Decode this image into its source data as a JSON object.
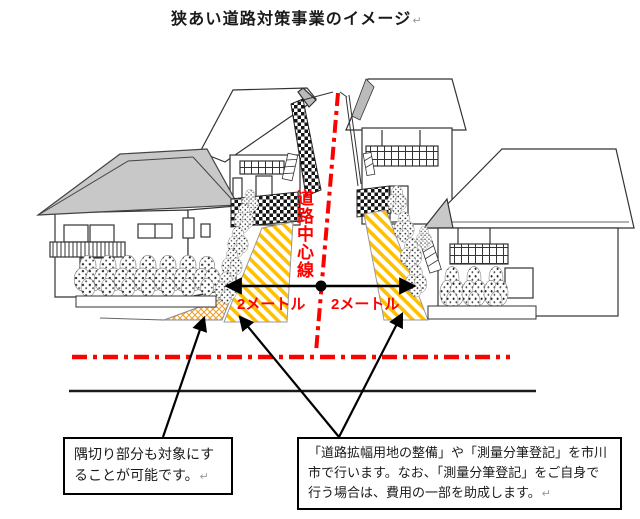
{
  "title": "狭あい道路対策事業のイメージ",
  "return_mark": "↵",
  "diagram": {
    "road_center_line_label": "道路中心線",
    "left_setback_label": "2メートル",
    "right_setback_label": "2メートル"
  },
  "notes": {
    "left": {
      "lines": [
        "隅切り部分も対象にす",
        "ることが可能です。"
      ]
    },
    "right": {
      "lines": [
        "「道路拡幅用地の整備」や「測量分筆登記」を市川",
        "市で行います。なお、「測量分筆登記」をご自身で",
        "行う場合は、費用の一部を助成します。"
      ]
    }
  },
  "colors": {
    "accent_red": "#FF0000",
    "setback_hatch": "#FFC000",
    "corner_hatch": "#F0A030",
    "roof_gray": "#C8C8C8",
    "wall_checker": "#151515",
    "line_black": "#1A1A1A"
  }
}
